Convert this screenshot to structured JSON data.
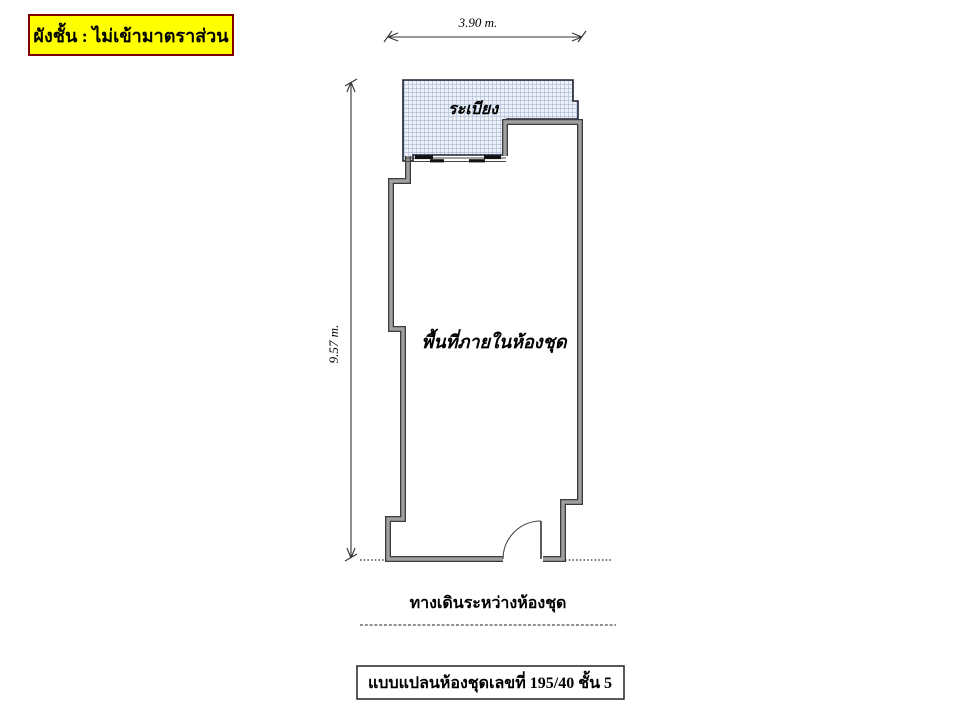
{
  "header": {
    "scale_note": "ผังชั้น : ไม่เข้ามาตราส่วน"
  },
  "dimensions": {
    "width_label": "3.90 m.",
    "height_label": "9.57 m."
  },
  "plan": {
    "balcony_label": "ระเบียง",
    "room_label": "พื้นที่ภายในห้องชุด",
    "corridor_label": "ทางเดินระหว่างห้องชุด"
  },
  "footer": {
    "title_label": "แบบแปลนห้องชุดเลขที่ 195/40  ชั้น 5"
  },
  "colors": {
    "highlight_bg": "#ffff00",
    "highlight_border": "#7f0000",
    "wall_core": "#a0a0a0",
    "wall_edge": "#3c3c3c",
    "hatch_line": "#aebfd8",
    "hatch_bg": "#eef2f8",
    "outline": "#1c2030",
    "ink": "#000000"
  }
}
